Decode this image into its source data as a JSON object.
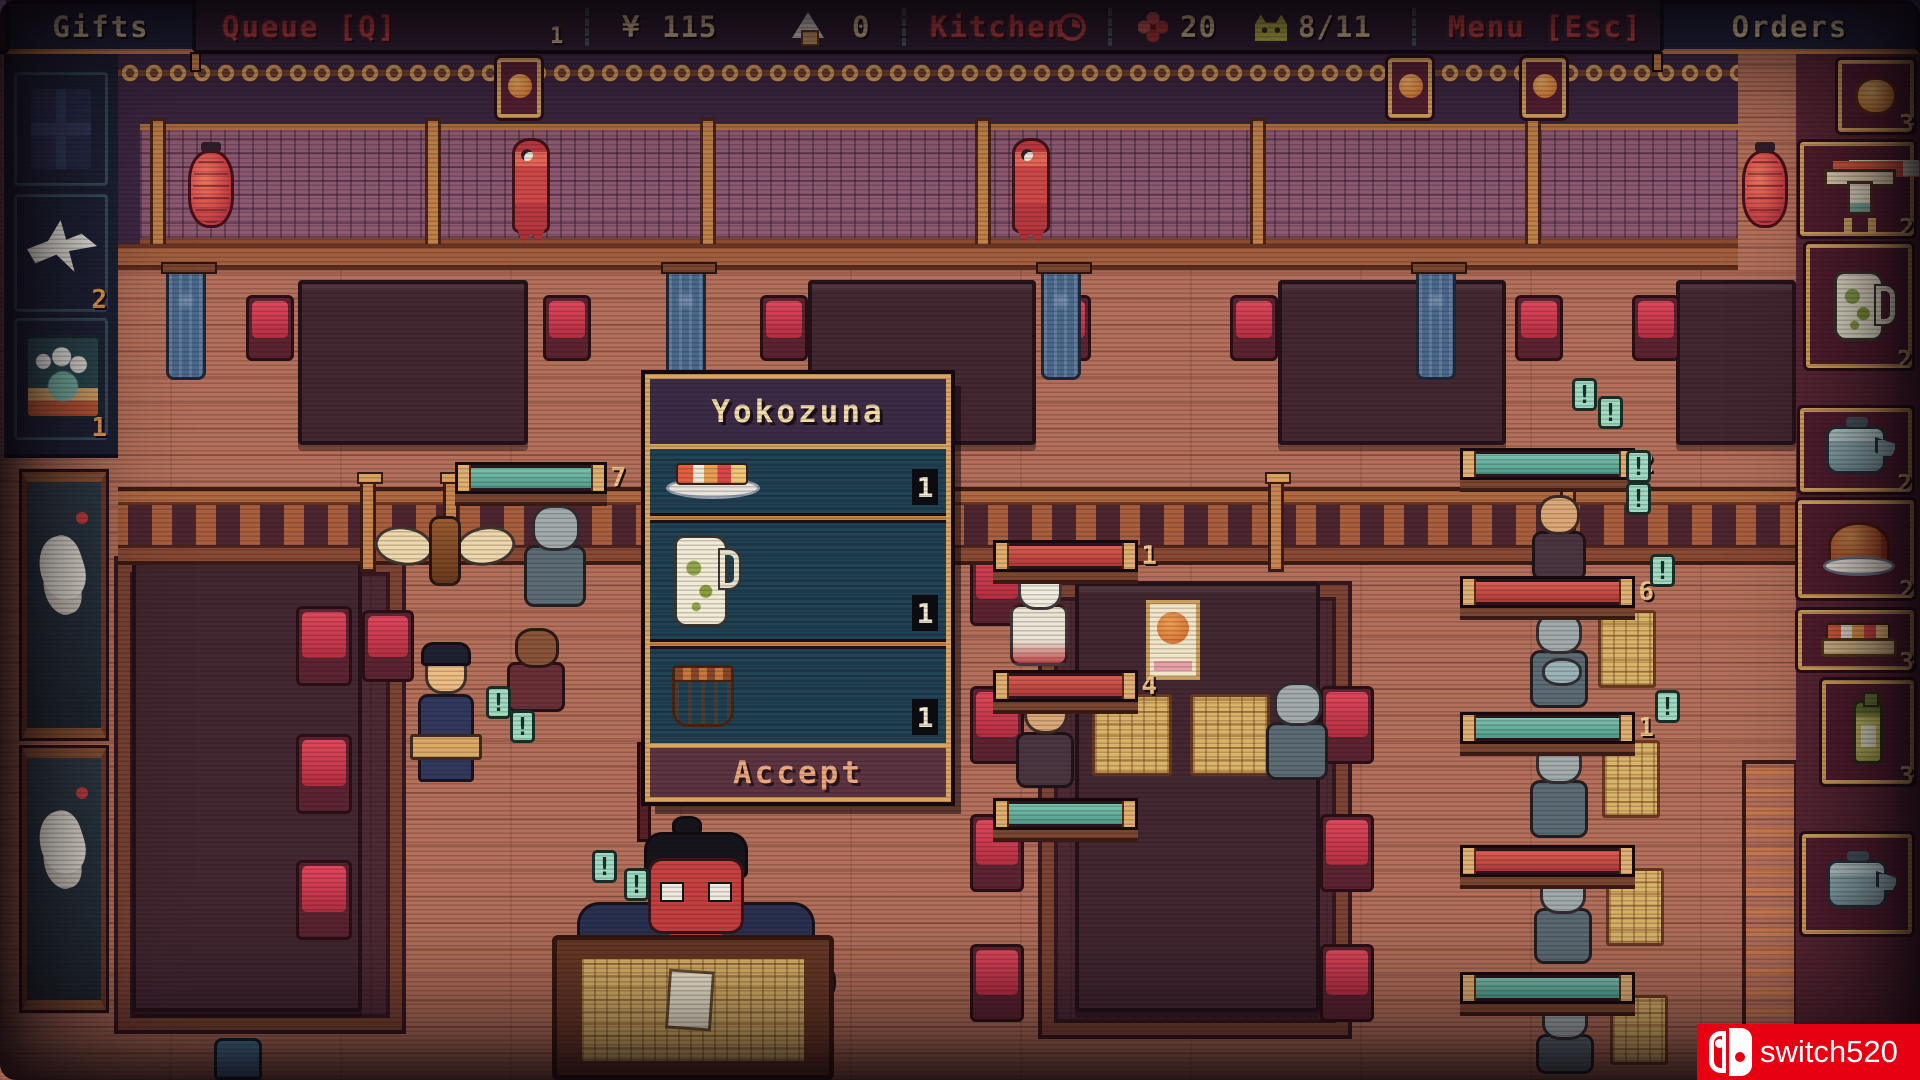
{
  "topbar": {
    "tabs": {
      "gifts": "Gifts",
      "orders": "Orders"
    },
    "queue": {
      "label": "Queue [Q]",
      "count": "1"
    },
    "money": {
      "symbol": "¥",
      "value": "115"
    },
    "rice": {
      "count": "0"
    },
    "kitchen": {
      "label": "Kitchen"
    },
    "flowers": {
      "count": "20"
    },
    "seats": {
      "value": "8/11"
    },
    "menu": {
      "label": "Menu [Esc]"
    }
  },
  "gifts_panel": {
    "slots": [
      {
        "name": "gift-box",
        "count": ""
      },
      {
        "name": "paper-crane",
        "count": "2"
      },
      {
        "name": "wave-art",
        "count": "1"
      }
    ]
  },
  "orders_panel": {
    "slots": [
      {
        "name": "bun",
        "count": "3"
      },
      {
        "name": "sushi-stand",
        "count": "2"
      },
      {
        "name": "pitcher",
        "count": "2"
      },
      {
        "name": "teapot",
        "count": "2"
      },
      {
        "name": "roast",
        "count": "2"
      },
      {
        "name": "sushi-platter",
        "count": "3"
      },
      {
        "name": "sake-bottle",
        "count": "3"
      },
      {
        "name": "teapot",
        "count": ""
      }
    ]
  },
  "dialog": {
    "title": "Yokozuna",
    "items": [
      {
        "name": "sushi-plate",
        "qty": "1"
      },
      {
        "name": "pitcher",
        "qty": "1"
      },
      {
        "name": "clay-pot",
        "qty": "1"
      }
    ],
    "accept": "Accept"
  },
  "scene": {
    "exclamation": "!",
    "progress_bars": [
      {
        "value": "7",
        "fill": "teal"
      },
      {
        "value": "1",
        "fill": "red"
      },
      {
        "value": "4",
        "fill": "red"
      },
      {
        "value": "2",
        "fill": "teal"
      },
      {
        "value": "6",
        "fill": "red"
      },
      {
        "value": "1",
        "fill": "teal"
      }
    ]
  },
  "watermark": {
    "text": "switch520"
  }
}
